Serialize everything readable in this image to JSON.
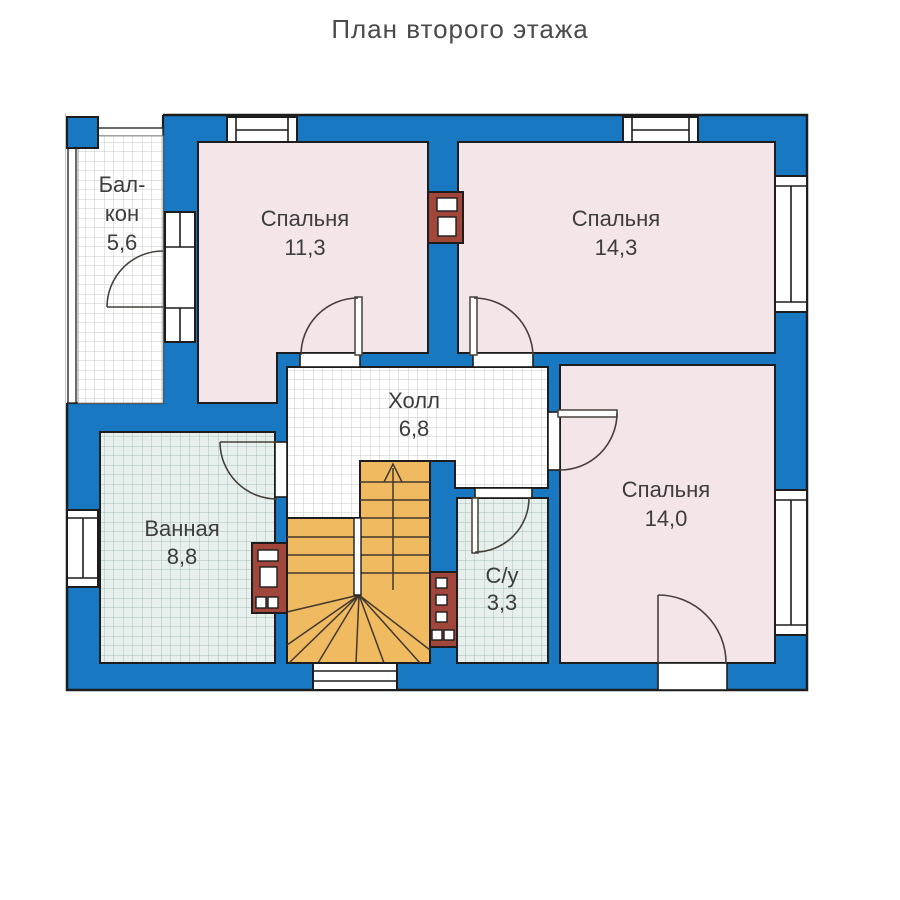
{
  "title": "План второго этажа",
  "colors": {
    "wall": "#1879c2",
    "outline": "#1d1d1d",
    "room": "#f3e5e8",
    "stairs": "#f0ba60",
    "chimney": "#a1463a",
    "tile_line": "#c9c9c9",
    "wet_tile_bg": "#e8f0ed",
    "wet_tile_line": "#a3c2ba",
    "text": "#3d3d3d"
  },
  "rooms": {
    "balcony": {
      "label_line1": "Бал-",
      "label_line2": "кон",
      "area": "5,6"
    },
    "bedroom_left": {
      "label": "Спальня",
      "area": "11,3"
    },
    "bedroom_right": {
      "label": "Спальня",
      "area": "14,3"
    },
    "hall": {
      "label": "Холл",
      "area": "6,8"
    },
    "bathroom": {
      "label": "Ванная",
      "area": "8,8"
    },
    "wc": {
      "label": "С/у",
      "area": "3,3"
    },
    "bedroom_bottom": {
      "label": "Спальня",
      "area": "14,0"
    }
  }
}
